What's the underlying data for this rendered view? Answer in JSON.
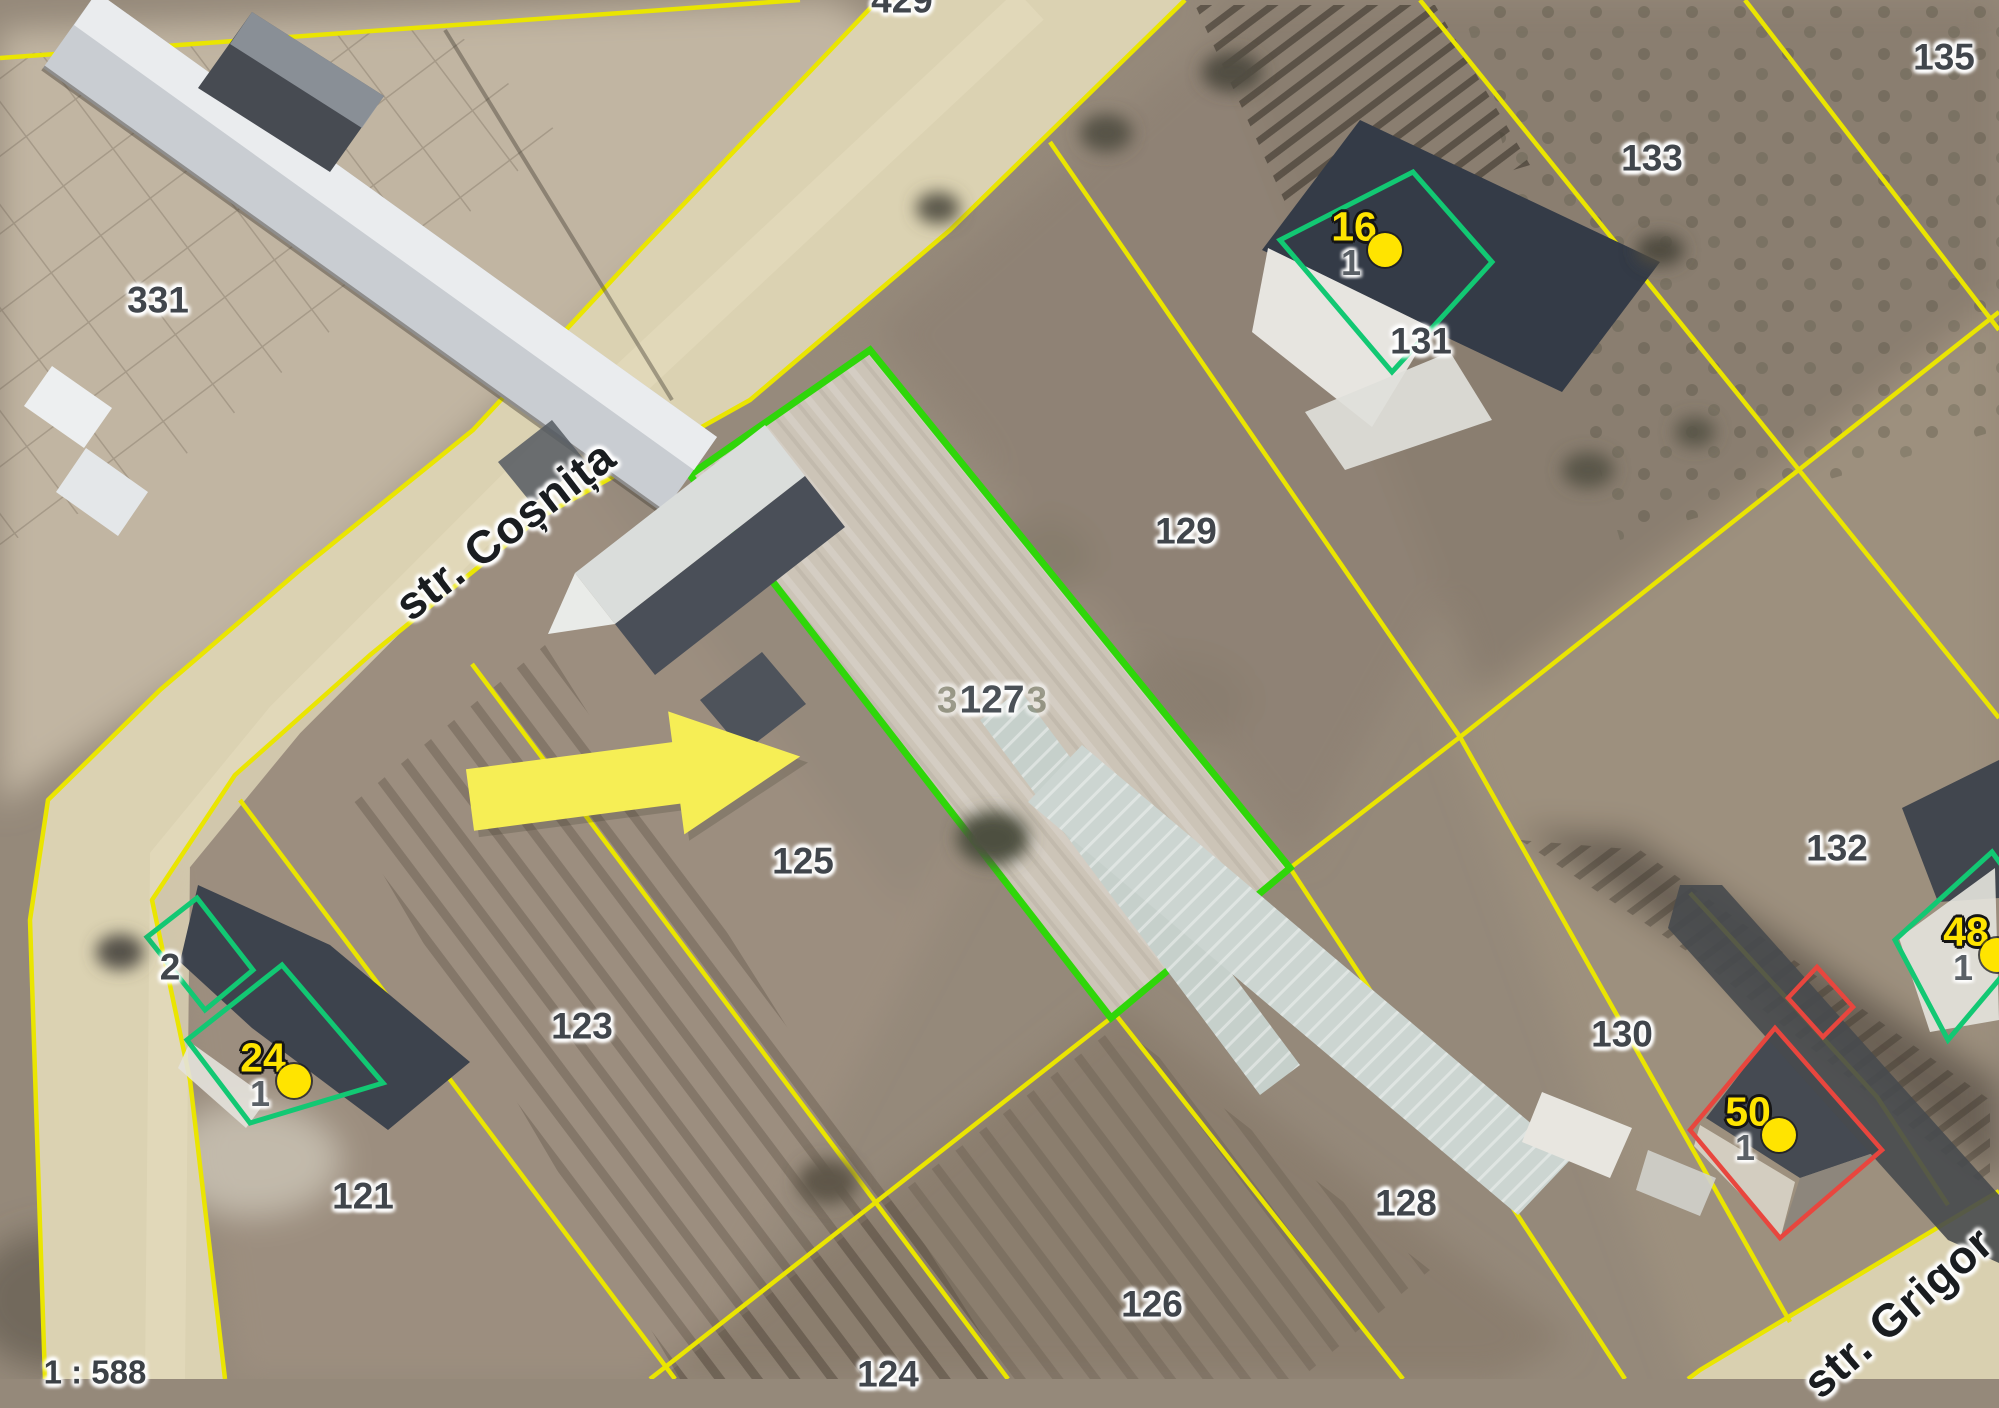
{
  "map": {
    "scale_label": "1 : 588",
    "streets": [
      {
        "name": "str. Coșnița",
        "x": 505,
        "y": 530,
        "angle": -37.5
      },
      {
        "name": "str. Grigor",
        "x": 1898,
        "y": 1312,
        "angle": -41
      }
    ],
    "selected_parcel": {
      "number": "127",
      "ghost_left": "3",
      "ghost_right": "3",
      "x": 992,
      "y": 700
    },
    "parcel_labels": [
      {
        "number": "331",
        "x": 158,
        "y": 300
      },
      {
        "number": "429",
        "x": 902,
        "y": 0
      },
      {
        "number": "135",
        "x": 1944,
        "y": 57
      },
      {
        "number": "133",
        "x": 1652,
        "y": 158
      },
      {
        "number": "131",
        "x": 1421,
        "y": 341
      },
      {
        "number": "129",
        "x": 1186,
        "y": 531
      },
      {
        "number": "125",
        "x": 803,
        "y": 861
      },
      {
        "number": "123",
        "x": 582,
        "y": 1026
      },
      {
        "number": "121",
        "x": 363,
        "y": 1196
      },
      {
        "number": "2",
        "x": 170,
        "y": 967
      },
      {
        "number": "124",
        "x": 888,
        "y": 1374
      },
      {
        "number": "126",
        "x": 1152,
        "y": 1304
      },
      {
        "number": "128",
        "x": 1406,
        "y": 1203
      },
      {
        "number": "130",
        "x": 1622,
        "y": 1034
      },
      {
        "number": "132",
        "x": 1837,
        "y": 848
      }
    ],
    "house_numbers": [
      {
        "number": "16",
        "unit": "1",
        "x": 1354,
        "y": 227
      },
      {
        "number": "24",
        "unit": "1",
        "x": 263,
        "y": 1058
      },
      {
        "number": "48",
        "unit": "1",
        "x": 1966,
        "y": 932
      },
      {
        "number": "50",
        "unit": "1",
        "x": 1748,
        "y": 1112
      }
    ],
    "colors": {
      "boundary_line": "#eae501",
      "selected_outline": "#2fd60a",
      "building_outline_green": "#12c873",
      "building_outline_red": "#e8463e",
      "house_number_dot": "#ffe400",
      "arrow": "#f6ee55"
    }
  }
}
